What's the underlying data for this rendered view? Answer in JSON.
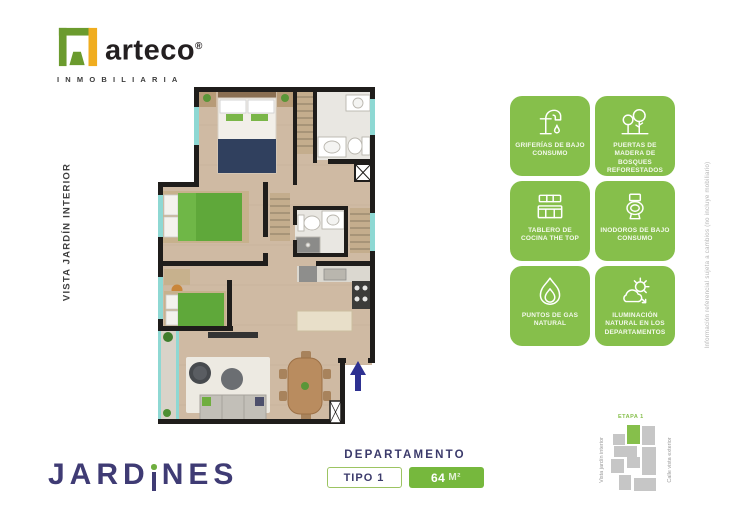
{
  "brand": {
    "name": "arteco",
    "reg": "®",
    "subtitle": "INMOBILIARIA",
    "green": "#6b9b2e",
    "yellow": "#f0ad1f"
  },
  "labels": {
    "left_vertical": "VISTA JARDÍN INTERIOR",
    "disclaimer": "Información referencial sujeta a cambios (no incluye mobiliario)"
  },
  "features": [
    {
      "icon": "faucet-icon",
      "label": "GRIFERÍAS DE BAJO CONSUMO"
    },
    {
      "icon": "trees-icon",
      "label": "PUERTAS DE MADERA DE BOSQUES REFORESTADOS"
    },
    {
      "icon": "kitchen-counter-icon",
      "label": "TABLERO DE COCINA THE TOP"
    },
    {
      "icon": "toilet-icon",
      "label": "INODOROS DE BAJO CONSUMO"
    },
    {
      "icon": "flame-icon",
      "label": "PUNTOS DE GAS NATURAL"
    },
    {
      "icon": "sunlight-icon",
      "label": "ILUMINACIÓN NATURAL EN LOS DEPARTAMENTOS"
    }
  ],
  "project": {
    "name": "JARDINES",
    "part_before_i": "JARD",
    "part_after_i": "NES",
    "navy": "#3f3b74"
  },
  "unit": {
    "heading": "DEPARTAMENTO",
    "type_label": "TIPO 1",
    "area_value": "64",
    "area_unit": "M²"
  },
  "siteplan": {
    "stage_label": "ETAPA 1",
    "left_label": "Vista jardín interior",
    "right_label": "Calle vista exterior"
  },
  "colors": {
    "badge_green": "#86bf4b",
    "chip_green": "#76b83d",
    "heading_navy": "#3b3a6b",
    "window_teal": "#8ed8d3",
    "wall_black": "#1f1d1b",
    "wood_floor": "#cfbaa3",
    "bed_green": "#5fa83a",
    "blanket_navy": "#30405e",
    "entry_arrow_navy": "#2e3191"
  }
}
